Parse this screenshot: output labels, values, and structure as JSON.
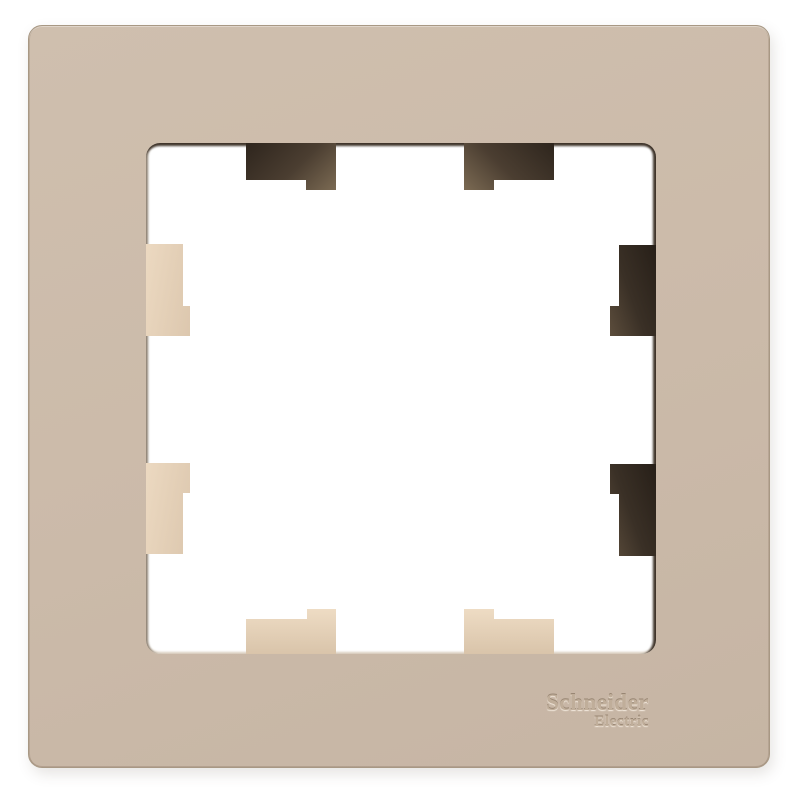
{
  "product_photo": {
    "description": "single-gang wall switch frame, milky beige plastic, square cutout with eight mounting tabs",
    "brand": {
      "line1": "Schneider",
      "line2": "Electric"
    },
    "tabs": [
      {
        "name": "mounting-tab-top-left",
        "shade": "dark"
      },
      {
        "name": "mounting-tab-top-right",
        "shade": "dark"
      },
      {
        "name": "mounting-tab-left-top",
        "shade": "light"
      },
      {
        "name": "mounting-tab-left-bottom",
        "shade": "light"
      },
      {
        "name": "mounting-tab-right-top",
        "shade": "dark"
      },
      {
        "name": "mounting-tab-right-bottom",
        "shade": "dark"
      },
      {
        "name": "mounting-tab-bottom-left",
        "shade": "light"
      },
      {
        "name": "mounting-tab-bottom-right",
        "shade": "light"
      }
    ]
  },
  "colors": {
    "background": "#ffffff",
    "frame_face": "#cbbaa9",
    "frame_face_light": "#cfbfae",
    "frame_face_dark": "#c6b5a4",
    "frame_edge": "#a89884",
    "opening_fill": "#ffffff",
    "recess_shadow_dark": "#3f342a",
    "recess_edge_left": "#8d8071",
    "recess_edge_bottom": "#d8ccbd",
    "tab_dark_1": "#2e251d",
    "tab_dark_2": "#7b6a53",
    "tab_light_1": "#ecd9c1",
    "tab_light_2": "#dcc7ae",
    "logo_text": "#c0ae9a"
  }
}
